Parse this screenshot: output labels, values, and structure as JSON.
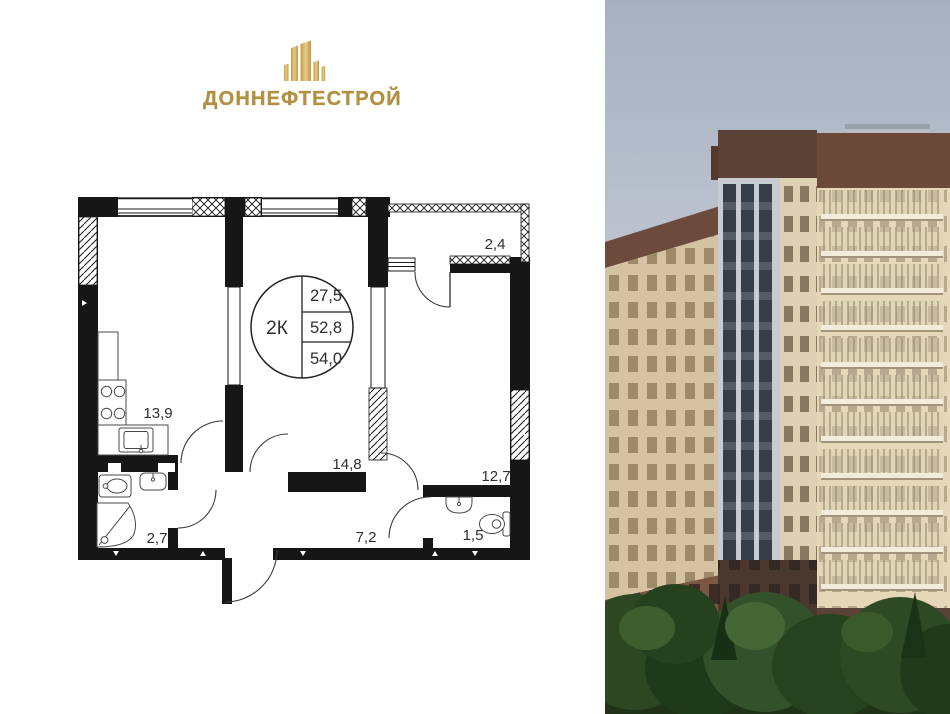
{
  "brand": {
    "name": "ДОННЕФТЕСТРОЙ",
    "icon": "buildings-icon",
    "gold_dark": "#bb9440",
    "gold_light": "#e5cb88"
  },
  "plan": {
    "badge": {
      "type": "2К",
      "rows": [
        "27,5",
        "52,8",
        "54,0"
      ]
    },
    "rooms": {
      "kitchen": "13,9",
      "bedroom": "14,8",
      "living": "12,7",
      "balcony": "2,4",
      "bathroom": "2,7",
      "hallway": "7,2",
      "wc": "1,5"
    },
    "wall_color": "#161616"
  },
  "photo": {
    "palette": {
      "sky": "#a9b1c3",
      "facade_cream": "#d8c6a5",
      "brick": "#6b4a3a",
      "tower_light": "#c9cdd5",
      "trees": "#2c4721"
    }
  }
}
